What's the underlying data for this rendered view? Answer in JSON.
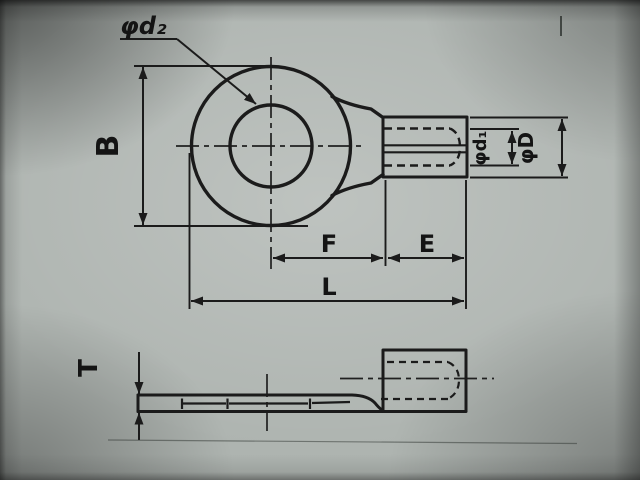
{
  "colors": {
    "background": "#aeb4b0",
    "line": "#1b1b1b"
  },
  "front_view": {
    "labels": {
      "hole_diameter": "φd₂",
      "tongue_width": "B",
      "wire_bore_diameter": "φd₁",
      "barrel_outside_diameter": "φD",
      "center_to_barrel": "F",
      "barrel_length": "E",
      "overall_length": "L"
    }
  },
  "side_view": {
    "labels": {
      "material_thickness": "T"
    }
  }
}
